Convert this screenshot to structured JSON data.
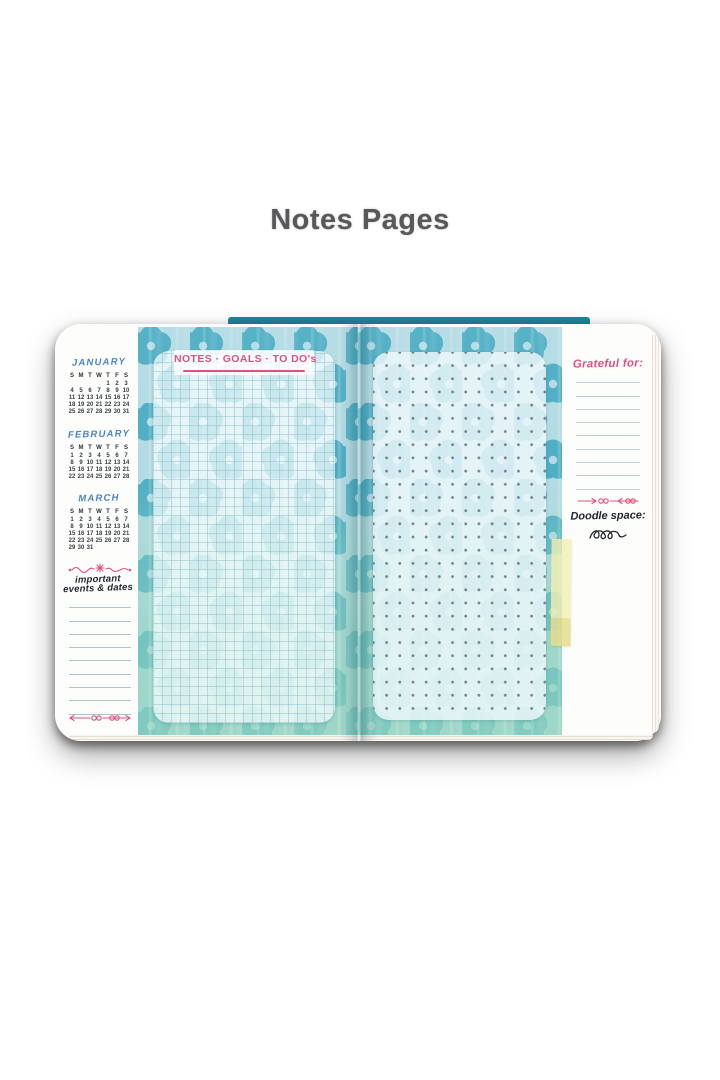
{
  "page": {
    "title": "Notes Pages"
  },
  "notebook": {
    "left_sidebar": {
      "day_headers": [
        "S",
        "M",
        "T",
        "W",
        "T",
        "F",
        "S"
      ],
      "months": [
        {
          "name": "JANUARY",
          "weeks": [
            [
              "",
              "",
              "",
              "",
              "1",
              "2",
              "3"
            ],
            [
              "4",
              "5",
              "6",
              "7",
              "8",
              "9",
              "10"
            ],
            [
              "11",
              "12",
              "13",
              "14",
              "15",
              "16",
              "17"
            ],
            [
              "18",
              "19",
              "20",
              "21",
              "22",
              "23",
              "24"
            ],
            [
              "25",
              "26",
              "27",
              "28",
              "29",
              "30",
              "31"
            ]
          ]
        },
        {
          "name": "FEBRUARY",
          "weeks": [
            [
              "1",
              "2",
              "3",
              "4",
              "5",
              "6",
              "7"
            ],
            [
              "8",
              "9",
              "10",
              "11",
              "12",
              "13",
              "14"
            ],
            [
              "15",
              "16",
              "17",
              "18",
              "19",
              "20",
              "21"
            ],
            [
              "22",
              "23",
              "24",
              "25",
              "26",
              "27",
              "28"
            ]
          ]
        },
        {
          "name": "MARCH",
          "weeks": [
            [
              "1",
              "2",
              "3",
              "4",
              "5",
              "6",
              "7"
            ],
            [
              "8",
              "9",
              "10",
              "11",
              "12",
              "13",
              "14"
            ],
            [
              "15",
              "16",
              "17",
              "18",
              "19",
              "20",
              "21"
            ],
            [
              "22",
              "23",
              "24",
              "25",
              "26",
              "27",
              "28"
            ],
            [
              "29",
              "30",
              "31",
              "",
              "",
              "",
              ""
            ]
          ]
        }
      ],
      "events_heading": "important events & dates",
      "ruled_lines": 9
    },
    "notes_page": {
      "header": "NOTES · GOALS · TO DO's",
      "style": "grid-paper"
    },
    "dot_page": {
      "style": "dot-grid"
    },
    "right_sidebar": {
      "grateful_heading": "Grateful for:",
      "ruled_lines": 9,
      "doodle_heading": "Doodle space:"
    }
  },
  "colors": {
    "accent_pink": "#e0527c",
    "month_blue": "#4c86c5",
    "ink_dark": "#23272e",
    "flower_teal": "#35a3bc",
    "flower_seafoam": "#7ec9b2",
    "pattern_bg": "#a9d6e0",
    "sticky_tab": "#f0ecaa",
    "title_gray": "#58585b"
  }
}
